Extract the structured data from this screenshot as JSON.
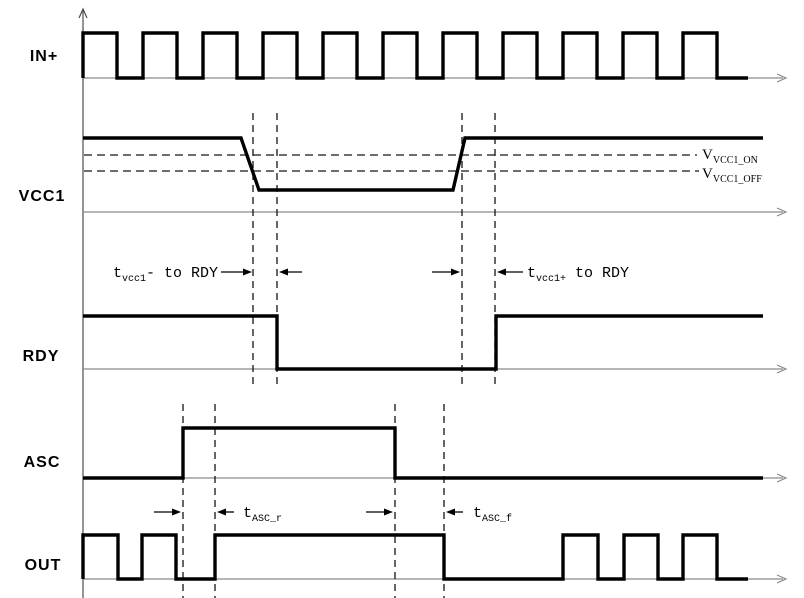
{
  "colors": {
    "background": "#ffffff",
    "waveform": "#000000",
    "axis_horizontal": "#8a8a8a",
    "axis_vertical": "#4d4d4d",
    "dashed_guide": "#141414",
    "text": "#000000"
  },
  "canvas": {
    "width": 804,
    "height": 598
  },
  "vertical_axis": {
    "x": 83,
    "y_top": 9,
    "y_bottom": 598
  },
  "axis_x_start": 83,
  "axis_x_arrow": 786,
  "rows": [
    {
      "name": "in-plus",
      "label": "IN+",
      "axis_y": 78,
      "label_x": 44,
      "label_y": 61
    },
    {
      "name": "vcc1",
      "label": "VCC1",
      "axis_y": 212,
      "label_x": 42,
      "label_y": 201
    },
    {
      "name": "rdy",
      "label": "RDY",
      "axis_y": 369,
      "label_x": 41,
      "label_y": 361
    },
    {
      "name": "asc",
      "label": "ASC",
      "axis_y": 478,
      "label_x": 42,
      "label_y": 467
    },
    {
      "name": "out",
      "label": "OUT",
      "axis_y": 579,
      "label_x": 43,
      "label_y": 570
    }
  ],
  "waveforms": [
    {
      "name": "in-plus-wave",
      "points": [
        [
          83,
          78
        ],
        [
          83,
          33
        ],
        [
          117,
          33
        ],
        [
          117,
          78
        ],
        [
          143,
          78
        ],
        [
          143,
          33
        ],
        [
          177,
          33
        ],
        [
          177,
          78
        ],
        [
          203,
          78
        ],
        [
          203,
          33
        ],
        [
          237,
          33
        ],
        [
          237,
          78
        ],
        [
          263,
          78
        ],
        [
          263,
          33
        ],
        [
          297,
          33
        ],
        [
          297,
          78
        ],
        [
          323,
          78
        ],
        [
          323,
          33
        ],
        [
          357,
          33
        ],
        [
          357,
          78
        ],
        [
          383,
          78
        ],
        [
          383,
          33
        ],
        [
          417,
          33
        ],
        [
          417,
          78
        ],
        [
          443,
          78
        ],
        [
          443,
          33
        ],
        [
          477,
          33
        ],
        [
          477,
          78
        ],
        [
          503,
          78
        ],
        [
          503,
          33
        ],
        [
          537,
          33
        ],
        [
          537,
          78
        ],
        [
          563,
          78
        ],
        [
          563,
          33
        ],
        [
          597,
          33
        ],
        [
          597,
          78
        ],
        [
          623,
          78
        ],
        [
          623,
          33
        ],
        [
          657,
          33
        ],
        [
          657,
          78
        ],
        [
          683,
          78
        ],
        [
          683,
          33
        ],
        [
          717,
          33
        ],
        [
          717,
          78
        ],
        [
          748,
          78
        ]
      ]
    },
    {
      "name": "vcc1-wave",
      "points": [
        [
          83,
          138
        ],
        [
          241,
          138
        ],
        [
          259,
          190
        ],
        [
          453,
          190
        ],
        [
          465,
          138
        ],
        [
          763,
          138
        ]
      ]
    },
    {
      "name": "rdy-wave",
      "points": [
        [
          83,
          316
        ],
        [
          277,
          316
        ],
        [
          277,
          369
        ],
        [
          496,
          369
        ],
        [
          496,
          316
        ],
        [
          763,
          316
        ]
      ]
    },
    {
      "name": "asc-wave",
      "points": [
        [
          83,
          478
        ],
        [
          183,
          478
        ],
        [
          183,
          428
        ],
        [
          395,
          428
        ],
        [
          395,
          478
        ],
        [
          763,
          478
        ]
      ]
    },
    {
      "name": "out-wave",
      "points": [
        [
          83,
          579
        ],
        [
          83,
          535
        ],
        [
          118,
          535
        ],
        [
          118,
          579
        ],
        [
          142,
          579
        ],
        [
          142,
          535
        ],
        [
          176,
          535
        ],
        [
          176,
          579
        ],
        [
          215,
          579
        ],
        [
          215,
          535
        ],
        [
          444,
          535
        ],
        [
          444,
          579
        ],
        [
          563,
          579
        ],
        [
          563,
          535
        ],
        [
          598,
          535
        ],
        [
          598,
          579
        ],
        [
          624,
          579
        ],
        [
          624,
          535
        ],
        [
          658,
          535
        ],
        [
          658,
          579
        ],
        [
          683,
          579
        ],
        [
          683,
          535
        ],
        [
          717,
          535
        ],
        [
          717,
          579
        ],
        [
          748,
          579
        ]
      ]
    }
  ],
  "dashed_vertical": [
    {
      "name": "guide-vcc1-off-cross",
      "x": 253,
      "y1": 113,
      "y2": 388
    },
    {
      "name": "guide-rdy-fall",
      "x": 277,
      "y1": 113,
      "y2": 388
    },
    {
      "name": "guide-vcc1-on-cross",
      "x": 462,
      "y1": 113,
      "y2": 388
    },
    {
      "name": "guide-rdy-rise",
      "x": 495,
      "y1": 113,
      "y2": 388
    },
    {
      "name": "guide-asc-rise",
      "x": 183,
      "y1": 404,
      "y2": 598
    },
    {
      "name": "guide-out-rise",
      "x": 215,
      "y1": 404,
      "y2": 598
    },
    {
      "name": "guide-asc-fall",
      "x": 395,
      "y1": 404,
      "y2": 598
    },
    {
      "name": "guide-out-fall",
      "x": 444,
      "y1": 404,
      "y2": 598
    }
  ],
  "dashed_horizontal": [
    {
      "name": "vcc1-on-level",
      "y": 155,
      "x1": 84,
      "x2": 697
    },
    {
      "name": "vcc1-off-level",
      "y": 171,
      "x1": 84,
      "x2": 699
    }
  ],
  "threshold_labels": [
    {
      "name": "v-vcc1-on-label",
      "x": 702,
      "y": 159,
      "parts": [
        {
          "t": "V"
        },
        {
          "t": "VCC1_ON",
          "sub": true
        }
      ]
    },
    {
      "name": "v-vcc1-off-label",
      "x": 702,
      "y": 178,
      "parts": [
        {
          "t": "V"
        },
        {
          "t": "VCC1_OFF",
          "sub": true
        }
      ]
    }
  ],
  "timing_annotations": [
    {
      "name": "t-vcc1-minus-to-rdy-label",
      "x": 218,
      "y": 277,
      "anchor": "end",
      "parts": [
        {
          "t": "t"
        },
        {
          "t": "vcc1",
          "sub": true
        },
        {
          "t": "- to RDY"
        }
      ]
    },
    {
      "name": "t-vcc1-plus-to-rdy-label",
      "x": 527,
      "y": 277,
      "anchor": "start",
      "parts": [
        {
          "t": "t"
        },
        {
          "t": "vcc1+",
          "sub": true
        },
        {
          "t": " to RDY"
        }
      ]
    },
    {
      "name": "t-asc-r-label",
      "x": 243,
      "y": 517,
      "anchor": "start",
      "parts": [
        {
          "t": "t"
        },
        {
          "t": "ASC_r",
          "sub": true
        }
      ]
    },
    {
      "name": "t-asc-f-label",
      "x": 473,
      "y": 517,
      "anchor": "start",
      "parts": [
        {
          "t": "t"
        },
        {
          "t": "ASC_f",
          "sub": true
        }
      ]
    }
  ],
  "measure_arrows": [
    {
      "name": "arrow-to-guide-vcc1-off",
      "tail": [
        221,
        272
      ],
      "head": [
        252,
        272
      ]
    },
    {
      "name": "arrow-to-guide-rdy-fall",
      "tail": [
        302,
        272
      ],
      "head": [
        279,
        272
      ]
    },
    {
      "name": "arrow-to-guide-vcc1-on",
      "tail": [
        432,
        272
      ],
      "head": [
        460,
        272
      ]
    },
    {
      "name": "arrow-to-guide-rdy-rise",
      "tail": [
        523,
        272
      ],
      "head": [
        497,
        272
      ]
    },
    {
      "name": "arrow-to-guide-asc-rise",
      "tail": [
        154,
        512
      ],
      "head": [
        181,
        512
      ]
    },
    {
      "name": "arrow-to-guide-out-rise",
      "tail": [
        234,
        512
      ],
      "head": [
        217,
        512
      ]
    },
    {
      "name": "arrow-to-guide-asc-fall",
      "tail": [
        366,
        512
      ],
      "head": [
        393,
        512
      ]
    },
    {
      "name": "arrow-to-guide-out-fall",
      "tail": [
        463,
        512
      ],
      "head": [
        446,
        512
      ]
    }
  ],
  "font_sizes": {
    "anno_main": 15,
    "anno_sub": 10,
    "thresh_main": 15,
    "thresh_sub": 10
  }
}
